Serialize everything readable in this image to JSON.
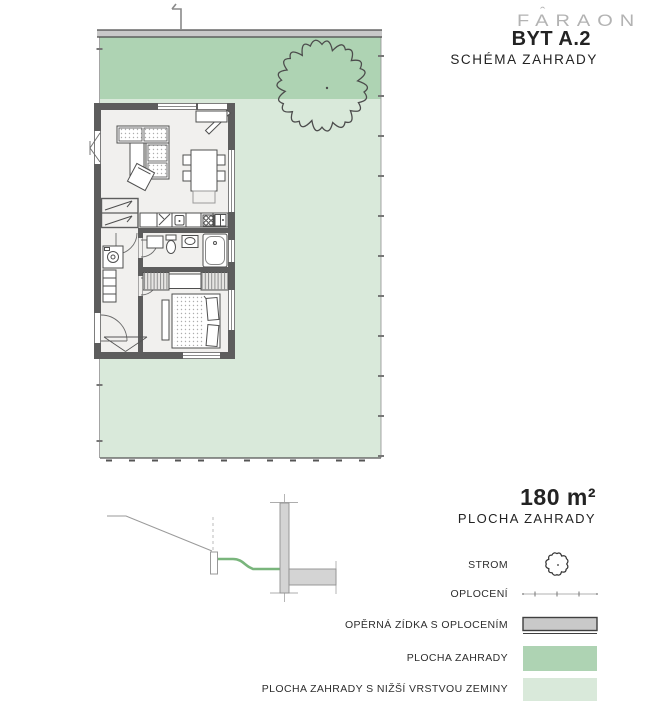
{
  "header": {
    "logo": "FARAON",
    "title": "BYT A.2",
    "subtitle": "SCHÉMA ZAHRADY"
  },
  "area": {
    "value": "180 m²",
    "label": "PLOCHA ZAHRADY"
  },
  "legend": {
    "items": [
      {
        "label": "STROM",
        "icon": "tree-icon"
      },
      {
        "label": "OPLOCENÍ",
        "icon": "fence-line-icon"
      },
      {
        "label": "OPĚRNÁ ZÍDKA S OPLOCENÍM",
        "icon": "retaining-wall-icon"
      },
      {
        "label": "PLOCHA ZAHRADY",
        "icon": "garden-area-swatch"
      },
      {
        "label": "PLOCHA ZAHRADY S NIŽŠÍ VRSTVOU ZEMINY",
        "icon": "garden-lower-soil-swatch"
      }
    ]
  },
  "colors": {
    "garden": "#aed3b3",
    "garden_lower_soil": "#d9e9da",
    "retaining_wall": "#c9c9c9",
    "wall": "#5d5d5d",
    "floor": "#f1f0ee",
    "terrain_green": "#79b57c",
    "logo_gray": "#b3b3b3",
    "text": "#232323",
    "line_gray": "#9a9a9a"
  }
}
